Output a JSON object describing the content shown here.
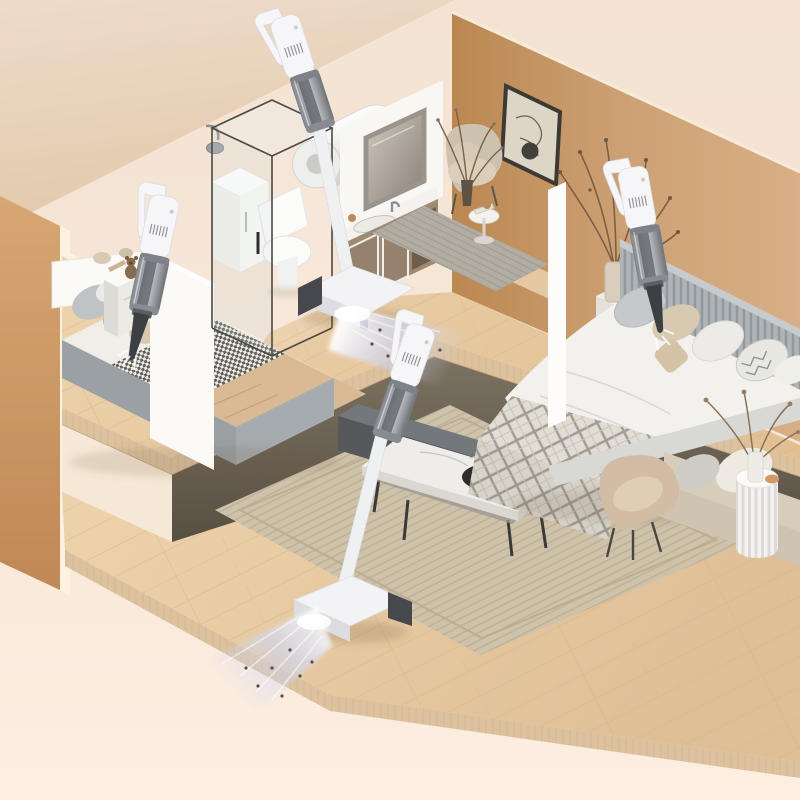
{
  "meta": {
    "type": "product-render",
    "view": "isometric-two-level-home-cutaway",
    "alt": "Isometric cutaway of a two-story apartment with four cordless stick and handheld vacuum cleaners cleaning bedrooms, bathroom floor and living room floor, warm beige and wood palette"
  },
  "scene": {
    "palette": {
      "bg_top": "#f4e3d3",
      "bg_bottom": "#fdeee1",
      "ceiling": "#e9d6c1",
      "wall_cream": "#fdf1e0",
      "wall_tan": "#cda174",
      "wall_caramel": "#d3a06f",
      "wall_white": "#fbfaf7",
      "floor_wood": "#ebd0a9",
      "floor_wood_lower": "#e9cda6",
      "slab_side": "#dcc29e",
      "under_dark": "#675f4f",
      "bench_gray": "#56585c",
      "rug_living": "#cfc2ab",
      "rug_nook": "#b2ada4",
      "marble": "#efede9",
      "table_black": "#2e2d2b",
      "sofa_beige": "#d8cdbb",
      "chair_tan": "#d2bca3",
      "side_table_white": "#f3f2f0",
      "duvet_white": "#f3f1ed",
      "headboard_gray": "#aeb4b8",
      "bed_base_gray": "#9aa0a4",
      "pillow_beige": "#d8c9b1",
      "blanket_tan": "#d9ba95",
      "vacuum_white": "#f6f6f8",
      "vacuum_gray": "#9aa0a6",
      "vacuum_dark": "#3c3f44",
      "glow_blue": "#c3cef5",
      "dust_speck": "#55504a",
      "frame_dark": "#3d3a35",
      "art_paper": "#ddd5c6",
      "heater_white": "#f3f3f1",
      "vanity_taupe": "#9e8a73",
      "mirror_glass": "#b7b1a8",
      "plant_brown": "#7b6046",
      "teddy_brown": "#8a6a4f"
    },
    "areas": {
      "structure": {
        "label": "structure",
        "items": [
          "ceiling plane",
          "caramel exterior wall",
          "cream back wall",
          "tan back wall",
          "white partition walls",
          "upper wood floor slab",
          "lower wood floor slab"
        ]
      },
      "left_bedroom": {
        "label": "left bedroom",
        "items": [
          "bed with houndstooth blanket",
          "white headboard",
          "pillows",
          "nightstand",
          "teddy bear",
          "handheld vacuum"
        ]
      },
      "bathroom": {
        "label": "bathroom",
        "items": [
          "glass shower enclosure",
          "toilet",
          "wall water heater",
          "shower head",
          "storage cabinet",
          "vanity with mirror",
          "stick vacuum with glowing head"
        ]
      },
      "sitting_nook": {
        "label": "sitting nook",
        "items": [
          "abstract wall art",
          "armchair",
          "gray rug",
          "round side table",
          "dried plant"
        ]
      },
      "right_bedroom": {
        "label": "right bedroom",
        "items": [
          "slatted headboard bed",
          "pillows",
          "plaid throw",
          "nightstand",
          "dried branches vase",
          "handheld vacuum"
        ]
      },
      "living_room": {
        "label": "lower living room",
        "items": [
          "woven rug",
          "marble coffee table with black inset",
          "media bench",
          "beige sofa",
          "accent chair",
          "white fluted side table",
          "dried flowers",
          "stick vacuum with glowing head"
        ]
      }
    },
    "vacuums": [
      {
        "id": "stick-vacuum-upper",
        "state": "cleaning floor with light beam"
      },
      {
        "id": "handheld-vacuum-left-bed",
        "state": "cleaning bed"
      },
      {
        "id": "handheld-vacuum-right-bed",
        "state": "cleaning bed"
      },
      {
        "id": "stick-vacuum-lower",
        "state": "cleaning floor with light beam"
      }
    ]
  }
}
